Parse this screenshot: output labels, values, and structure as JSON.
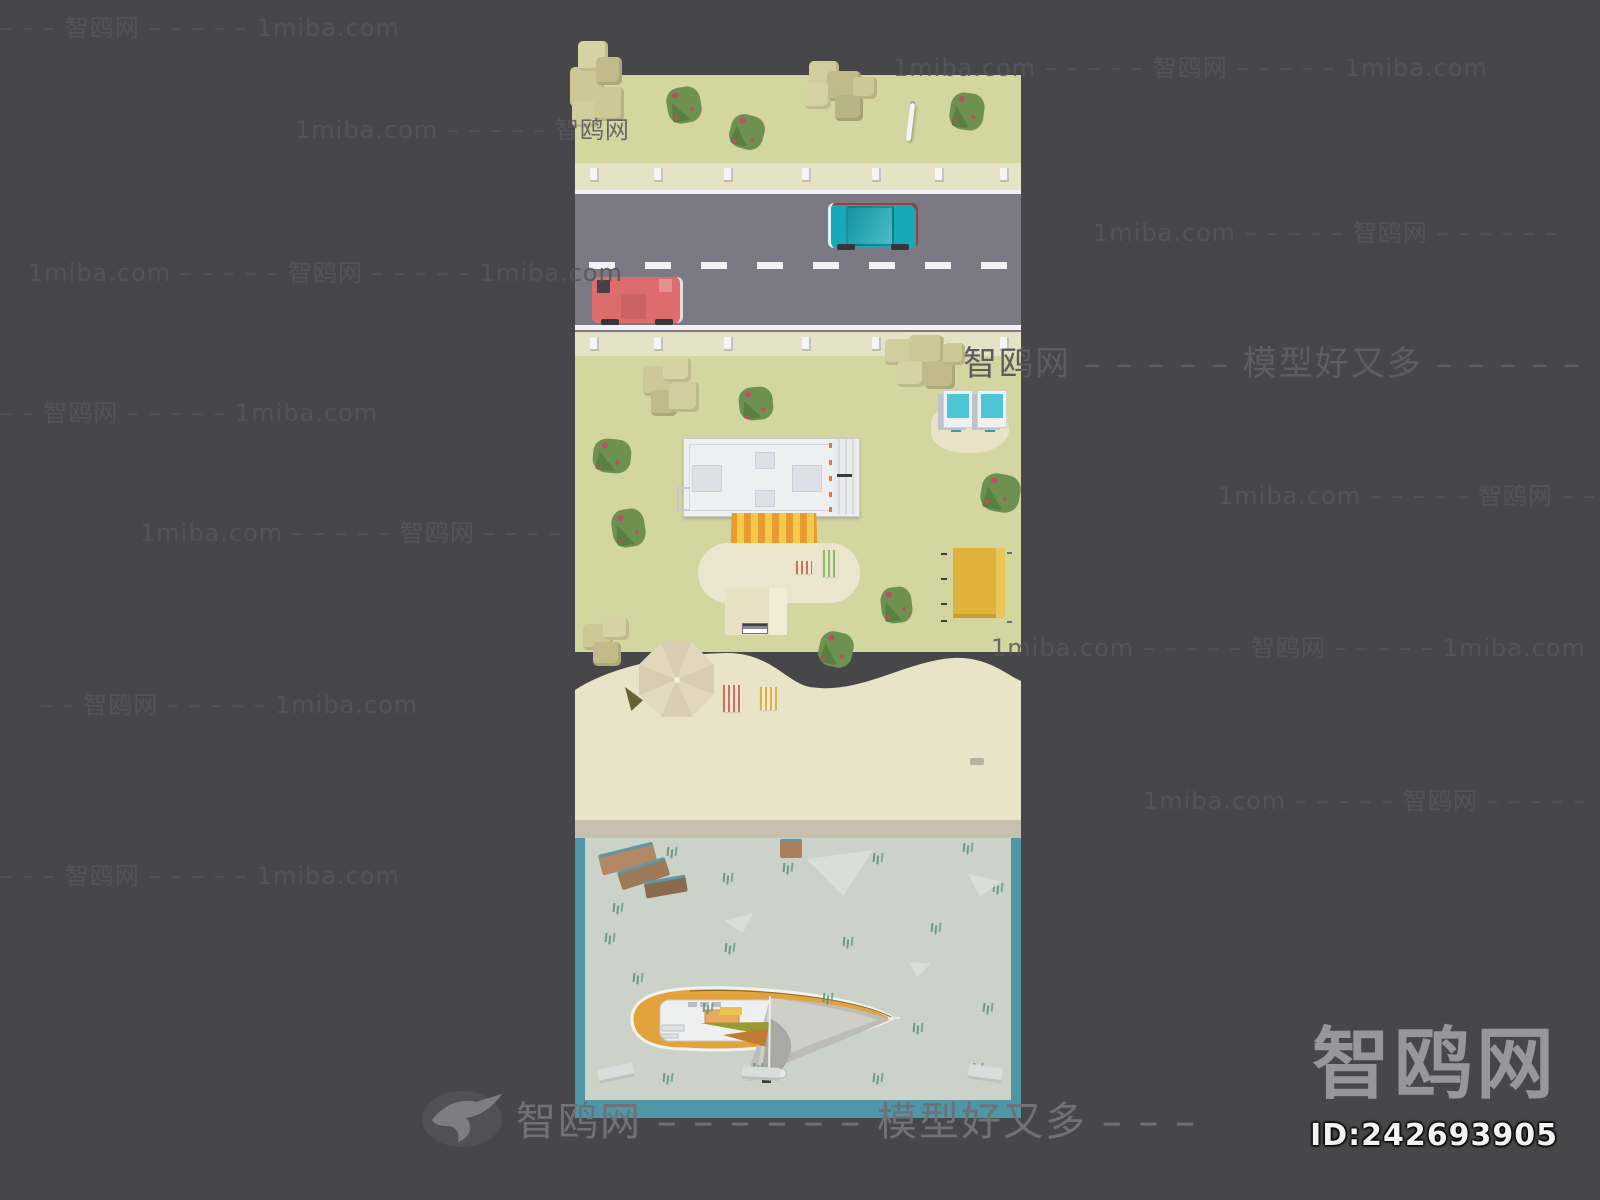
{
  "page": {
    "background_color": "#474749"
  },
  "watermark": {
    "site_name": "智鸥网",
    "domain": "1miba.com",
    "slogan": "模型好又多",
    "icon": "seagull-icon",
    "rows": [
      {
        "text": "– – – 智鸥网 – – – – – 1miba.com",
        "x": 0,
        "y": 8
      },
      {
        "text": "1miba.com – – – – – 智鸥网",
        "x": 295,
        "y": 110
      },
      {
        "text": "1miba.com – – – – – 智鸥网 – – – – – 1miba.com",
        "x": 28,
        "y": 253
      },
      {
        "text": "– – 智鸥网 – – – – – 1miba.com",
        "x": 0,
        "y": 393
      },
      {
        "text": "1miba.com – – – – – 智鸥网 – – – –",
        "x": 140,
        "y": 513
      },
      {
        "text": "– – 智鸥网 – – – – – 1miba.com",
        "x": 40,
        "y": 685
      },
      {
        "text": "– – – 智鸥网 – – – – – 1miba.com",
        "x": 0,
        "y": 856
      },
      {
        "text": "1miba.com – – – – – 智鸥网 – – – – – 1miba.com",
        "x": 893,
        "y": 48
      },
      {
        "text": "1miba.com – – – – – 智鸥网 – – – – – –",
        "x": 1093,
        "y": 213
      },
      {
        "text": "1miba.com – – – – – 智鸥网 – –",
        "x": 1218,
        "y": 476
      },
      {
        "text": "1miba.com – – – – – 智鸥网 – – – – – 1miba.com",
        "x": 991,
        "y": 628
      },
      {
        "text": "1miba.com – – – – – 智鸥网 – – – – –",
        "x": 1143,
        "y": 781
      }
    ],
    "big_row": {
      "text": "智鸥网 – – – – – 模型好又多 – – – – –",
      "x": 963,
      "y": 336
    },
    "footer_row": {
      "text": "智鸥网 – – – – – – 模型好又多 – – –"
    }
  },
  "footer_logo": {
    "logo_text": "智鸥网",
    "model_id": "ID:242693905"
  },
  "scene": {
    "subject": "low-poly beach street diorama top view with road, cars, beach house, umbrella and sailboat",
    "palette": {
      "bg": "#474749",
      "grass": "#d3d69f",
      "sidewalk": "#e5e2c6",
      "road": "#7a7984",
      "roadline": "#f2f1f4",
      "sand": "#e9e3c8",
      "shore": "#c8bfad",
      "water": "#cbd3c9",
      "waterBorder": "#4f96a6",
      "bldg": "#edeff1",
      "awnO": "#e89b30",
      "awnY": "#f2ca4c",
      "stall": "#dfb23b",
      "cyan": "#4cc5d5",
      "carT": "#17a9b8",
      "carR": "#dd6c6d",
      "bush": "#6e9150",
      "bushD": "#597f41",
      "berry": "#c14e5f",
      "tan": "#cdc895",
      "hull": "#e2a33c",
      "sail": "#bdbdb8",
      "patio": "#ebe5cd",
      "umbrella": "#ddd3b9",
      "weed": "#5e8f7a",
      "wm": "#56565a",
      "wmBig": "#5d5d61",
      "wmFoot": "#717175",
      "logo": "#97979a",
      "id": "#f2f2f2"
    }
  }
}
